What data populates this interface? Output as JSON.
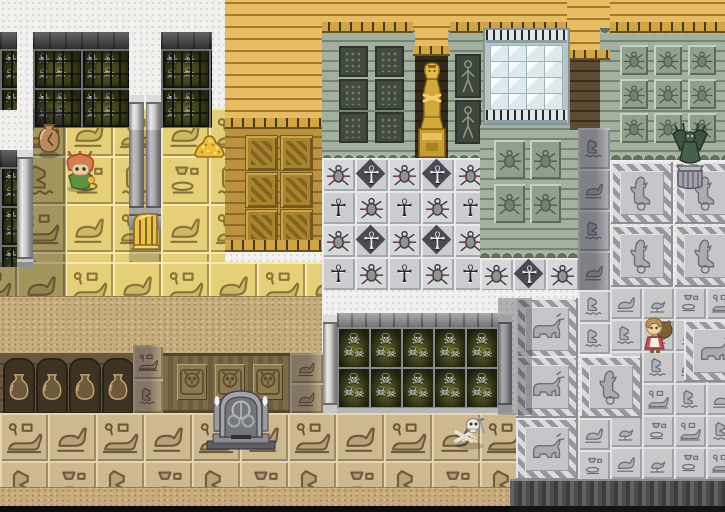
{
  "meta": {
    "kind": "game-map-screenshot",
    "scene": "egyptian-tomb-temple-tile-map",
    "width": 725,
    "height": 512,
    "visible_text": null
  },
  "palette": {
    "noise_bg": "#f2f1ef",
    "gold_brick": "#d9a94e",
    "gold_brick_line": "#a8792c",
    "gold_dark": "#b8913f",
    "gold_dark_line": "#8f6c26",
    "gold_panel": "#a8842f",
    "gold_panel_hi": "#c9a44d",
    "gold_panel_lo": "#75581d",
    "crenellation": "#d2a449",
    "crenellation_gap": "#4a3a14",
    "yellow_tile": "#e5cf78",
    "yellow_light": "#f6ebae",
    "yellow_dark": "#ab934d",
    "yellow_glyph": "#8a7336",
    "tan_tile": "#cdb88f",
    "tan_light": "#e4d6b2",
    "tan_dark": "#9d8963",
    "tan_glyph": "#6e5a3c",
    "silver_tile": "#c9c9cc",
    "silver_light": "#e3e3e6",
    "silver_dark": "#a0a0a6",
    "silver_glyph": "#70707a",
    "big_tile": "#c6c6ca",
    "big_tile_hi": "#e6e6e8",
    "big_frame_a": "#97979c",
    "big_frame_b": "#dcdce0",
    "big_glyph": "#6e6e74",
    "green_wall": "#9aa796",
    "green_line": "#76856f",
    "green_scallop": "#5f705b",
    "green_scallop_bg": "#adbba9",
    "panel_dark": "#434b41",
    "panel_dark_edge": "#2e342d",
    "panel_scarab": "#90a08e",
    "panel_scarab_glyph": "#4e5e4a",
    "stone_wall": "#5e5e5e",
    "stone_band": "#434343",
    "cage_glow": "#5e6226",
    "cage_dark": "#23250f",
    "niche_frame": "#87878a",
    "niche_glow": "#6a6e2e",
    "niche_dark": "#1c1e0e",
    "glass_frame": "#b9c5c5",
    "glass": "#dde9ec",
    "glass_hi": "#f7fbfc",
    "fence_spike": "#252a2e",
    "dark_brick": "#564430",
    "dark_brick_line": "#3a2e1e",
    "sandy": "#c6ab7c",
    "sandy_dot_dark": "#a8895a",
    "sandy_dot_light": "#dcc392",
    "urn_wall": "#6a573f",
    "urn_niche": "#3e3323",
    "urn_body": "#c6a271",
    "plank_a": "#7c6a49",
    "plank_b": "#6c5b3d",
    "lion_panel": "#8d7a52",
    "cliff_a": "#616161",
    "cliff_b": "#3c3c3c",
    "cliff_bottom": "#141414",
    "black_strip": "#0c0c0c",
    "ankh_light": "#ececf0",
    "ankh_dark": "#26262c",
    "ankh_diamond": "#4a4a55",
    "scarab_red": "#c23b3b",
    "shadow": "rgba(28,26,40,0.34)"
  },
  "legend": {
    "icons": {
      "skull-icon": "☠",
      "ankh-icon": "☥"
    },
    "glyph_tiles": [
      "lion92",
      "duck",
      "eagle",
      "bowls",
      "bird",
      "heron",
      "bull",
      "scarab"
    ],
    "tile_kinds": [
      "gold_brick",
      "gold_dark_wall",
      "crenellation",
      "glyph_floor",
      "skull_cage_wall",
      "skull_niche_wall",
      "green_wall",
      "glass_window",
      "ankh_field",
      "silver_patch",
      "pillar",
      "double_pillar",
      "alcove",
      "dark_brick",
      "sandy",
      "urn_wall",
      "lion_panel_wall",
      "dark_gray_band",
      "black_strip"
    ]
  },
  "regions": [
    {
      "name": "gold-roof-left",
      "type": "gold_brick",
      "x": 225,
      "y": 0,
      "w": 97,
      "h": 122
    },
    {
      "name": "gold-roof-band",
      "type": "gold_brick",
      "x": 322,
      "y": 0,
      "w": 403,
      "h": 26
    },
    {
      "name": "gold-alcove-cap",
      "type": "gold_brick",
      "x": 413,
      "y": 0,
      "w": 37,
      "h": 50
    },
    {
      "name": "gold-column-cap",
      "type": "gold_brick",
      "x": 567,
      "y": 0,
      "w": 43,
      "h": 54
    },
    {
      "name": "yellow-floor-upper",
      "type": "glyph_floor",
      "style": "yellow",
      "x": 33,
      "y": 108,
      "w": 192,
      "h": 154,
      "tile": 48,
      "ox": -16
    },
    {
      "name": "yellow-floor-row",
      "type": "glyph_floor",
      "style": "yellow",
      "x": 0,
      "y": 262,
      "w": 322,
      "h": 34,
      "tile": 48,
      "ox": -31
    },
    {
      "name": "door-panel-wall",
      "type": "gold_dark_wall",
      "x": 225,
      "y": 128,
      "w": 97,
      "h": 118
    },
    {
      "name": "green-wall-left",
      "type": "green_wall",
      "x": 322,
      "y": 30,
      "w": 93,
      "h": 130,
      "scallop_bottom": true,
      "panels": {
        "kind": "dark",
        "cols": 2,
        "rows": 3,
        "x0": 17,
        "y0": 16,
        "pw": 25,
        "ph": 27,
        "gx": 36,
        "gy": 33
      }
    },
    {
      "name": "green-wall-mid",
      "type": "green_wall",
      "x": 448,
      "y": 30,
      "w": 35,
      "h": 130,
      "scallop_bottom": true,
      "panels": {
        "kind": "figure",
        "cols": 1,
        "rows": 2,
        "x0": 7,
        "y0": 24,
        "pw": 22,
        "ph": 40,
        "gx": 0,
        "gy": 46
      }
    },
    {
      "name": "green-wall-right",
      "type": "green_wall",
      "x": 600,
      "y": 28,
      "w": 125,
      "h": 132,
      "scallop_top": true,
      "scallop_bottom": true,
      "panels": {
        "kind": "scarab",
        "cols": 3,
        "rows": 3,
        "x0": 20,
        "y0": 17,
        "pw": 28,
        "ph": 30,
        "gx": 34,
        "gy": 34
      }
    },
    {
      "name": "green-wall-below-window",
      "type": "green_wall",
      "x": 480,
      "y": 125,
      "w": 98,
      "h": 133,
      "scallop_bottom": true,
      "panels": {
        "kind": "scarab",
        "cols": 2,
        "rows": 2,
        "x0": 14,
        "y0": 15,
        "pw": 31,
        "ph": 39,
        "gx": 36,
        "gy": 44
      }
    },
    {
      "name": "dark-brick-column",
      "type": "dark_brick",
      "x": 570,
      "y": 54,
      "w": 30,
      "h": 76
    },
    {
      "name": "alcove",
      "type": "alcove",
      "x": 415,
      "y": 48,
      "w": 33,
      "h": 112
    },
    {
      "name": "crenellation-a",
      "type": "crenellation",
      "x": 322,
      "y": 22,
      "w": 91,
      "h": 11
    },
    {
      "name": "crenellation-b",
      "type": "crenellation",
      "x": 450,
      "y": 22,
      "w": 117,
      "h": 11
    },
    {
      "name": "crenellation-c",
      "type": "crenellation",
      "x": 610,
      "y": 22,
      "w": 115,
      "h": 11
    },
    {
      "name": "crenellation-alcove",
      "type": "crenellation",
      "x": 413,
      "y": 46,
      "w": 37,
      "h": 10
    },
    {
      "name": "crenellation-column",
      "type": "crenellation",
      "x": 567,
      "y": 50,
      "w": 43,
      "h": 10
    },
    {
      "name": "crenellation-roof-left",
      "type": "crenellation",
      "x": 225,
      "y": 118,
      "w": 97,
      "h": 11
    },
    {
      "name": "crenellation-door-wall",
      "type": "crenellation",
      "x": 225,
      "y": 240,
      "w": 97,
      "h": 12
    },
    {
      "name": "window",
      "type": "glass_window",
      "x": 483,
      "y": 28,
      "w": 87,
      "h": 97
    },
    {
      "name": "skullcage-sliver",
      "type": "skull_cage_wall",
      "x": 0,
      "y": 32,
      "w": 17,
      "h": 78
    },
    {
      "name": "skullcage-a",
      "type": "skull_cage_wall",
      "x": 33,
      "y": 32,
      "w": 96,
      "h": 96
    },
    {
      "name": "skullcage-b",
      "type": "skull_cage_wall",
      "x": 161,
      "y": 32,
      "w": 51,
      "h": 96
    },
    {
      "name": "skullcage-c",
      "type": "skull_cage_wall",
      "x": 0,
      "y": 150,
      "w": 17,
      "h": 117
    },
    {
      "name": "pillar-wall-c",
      "type": "pillar",
      "x": 17,
      "y": 150,
      "w": 16,
      "h": 117
    },
    {
      "name": "double-pillar",
      "type": "double_pillar",
      "x": 129,
      "y": 95,
      "w": 32,
      "h": 135
    },
    {
      "name": "ankh-field",
      "type": "ankh_field",
      "x": 322,
      "y": 158,
      "w": 158,
      "h": 132,
      "tile": 33
    },
    {
      "name": "ankh-row-right",
      "type": "ankh_field",
      "x": 480,
      "y": 258,
      "w": 98,
      "h": 32,
      "tile": 33
    },
    {
      "name": "glyph-column-shadow",
      "type": "glyph_floor",
      "style": "silver",
      "x": 578,
      "y": 128,
      "w": 32,
      "h": 162,
      "tile": 32,
      "th": 41,
      "shade": true,
      "seq": [
        "eagle",
        "duck",
        "eagle",
        "duck"
      ]
    },
    {
      "name": "sandy-band-mid",
      "type": "sandy",
      "x": 0,
      "y": 296,
      "w": 322,
      "h": 57
    },
    {
      "name": "urn-wall",
      "type": "urn_wall",
      "x": 0,
      "y": 353,
      "w": 133,
      "h": 60
    },
    {
      "name": "mid-glyph-column-a",
      "type": "glyph_floor",
      "style": "tan",
      "x": 133,
      "y": 345,
      "w": 30,
      "h": 68,
      "tile": 30,
      "th": 34,
      "shade": true,
      "seq": [
        "lion92",
        "eagle"
      ]
    },
    {
      "name": "lion-panel-wall",
      "type": "lion_panel_wall",
      "x": 163,
      "y": 353,
      "w": 127,
      "h": 60
    },
    {
      "name": "mid-glyph-column-b",
      "type": "glyph_floor",
      "style": "tan",
      "x": 290,
      "y": 353,
      "w": 33,
      "h": 60,
      "tile": 33,
      "th": 30,
      "shade": true,
      "seq": [
        "duck",
        "duck"
      ]
    },
    {
      "name": "skull-niche-wall",
      "type": "skull_niche_wall",
      "x": 337,
      "y": 313,
      "w": 161,
      "h": 100
    },
    {
      "name": "pillar-skullwall-left",
      "type": "pillar",
      "x": 323,
      "y": 315,
      "w": 14,
      "h": 98
    },
    {
      "name": "pillar-skullwall-right",
      "type": "pillar",
      "x": 498,
      "y": 315,
      "w": 14,
      "h": 98
    },
    {
      "name": "tan-floor",
      "type": "glyph_floor",
      "style": "tan",
      "x": 0,
      "y": 413,
      "w": 516,
      "h": 74,
      "tile": 48
    },
    {
      "name": "silver-floor-patchwork",
      "type": "silver_patch",
      "x": 480,
      "y": 158,
      "w": 245,
      "h": 325,
      "bigSize": 62,
      "big": [
        {
          "g": "heron",
          "x": 611,
          "y": 162
        },
        {
          "g": "heron",
          "x": 675,
          "y": 162
        },
        {
          "g": "heron",
          "x": 611,
          "y": 225
        },
        {
          "g": "heron",
          "x": 675,
          "y": 225
        },
        {
          "g": "bull",
          "x": 516,
          "y": 298
        },
        {
          "g": "bull",
          "x": 516,
          "y": 356
        },
        {
          "g": "heron",
          "x": 580,
          "y": 356
        },
        {
          "g": "bull",
          "x": 684,
          "y": 320
        },
        {
          "g": "bull",
          "x": 516,
          "y": 418
        }
      ],
      "grid": {
        "x0": 610,
        "y0": 287,
        "cols": 4,
        "rows": 6,
        "t": 32
      },
      "extra": [
        [
          578,
          290
        ],
        [
          578,
          322
        ],
        [
          578,
          418
        ],
        [
          578,
          450
        ]
      ]
    },
    {
      "name": "sandy-band-bottom",
      "type": "sandy",
      "x": 0,
      "y": 487,
      "w": 510,
      "h": 19
    },
    {
      "name": "black-strip",
      "type": "black_strip",
      "x": 0,
      "y": 506,
      "w": 510,
      "h": 6
    },
    {
      "name": "cliff-band",
      "type": "dark_gray_band",
      "x": 510,
      "y": 479,
      "w": 215,
      "h": 33
    }
  ],
  "objects": [
    {
      "name": "broken-pot",
      "kind": "pot",
      "x": 33,
      "y": 121,
      "w": 32,
      "h": 38
    },
    {
      "name": "mandragora-sprite",
      "kind": "plant",
      "x": 63,
      "y": 151,
      "w": 35,
      "h": 42
    },
    {
      "name": "gold-pile",
      "kind": "goldpile",
      "x": 193,
      "y": 123,
      "w": 33,
      "h": 36
    },
    {
      "name": "golden-harp",
      "kind": "harp",
      "x": 127,
      "y": 209,
      "w": 36,
      "h": 42
    },
    {
      "name": "pharaoh-statue",
      "kind": "pharaoh",
      "x": 416,
      "y": 57,
      "w": 32,
      "h": 102
    },
    {
      "name": "gargoyle-statue",
      "kind": "gargoyle",
      "x": 670,
      "y": 122,
      "w": 40,
      "h": 74
    },
    {
      "name": "grave-monument",
      "kind": "monument",
      "x": 205,
      "y": 379,
      "w": 72,
      "h": 72
    },
    {
      "name": "skeleton-remains",
      "kind": "skeleton",
      "x": 451,
      "y": 413,
      "w": 38,
      "h": 38
    },
    {
      "name": "doll-npc",
      "kind": "doll",
      "x": 641,
      "y": 315,
      "w": 32,
      "h": 42
    }
  ],
  "shadows": [
    {
      "x": 33,
      "y": 108,
      "w": 33,
      "h": 188,
      "o": 0.32
    },
    {
      "x": 0,
      "y": 262,
      "w": 33,
      "h": 34,
      "o": 0.32
    },
    {
      "x": 129,
      "y": 130,
      "w": 32,
      "h": 132,
      "o": 0.2
    },
    {
      "x": 498,
      "y": 298,
      "w": 34,
      "h": 117,
      "o": 0.3
    }
  ]
}
